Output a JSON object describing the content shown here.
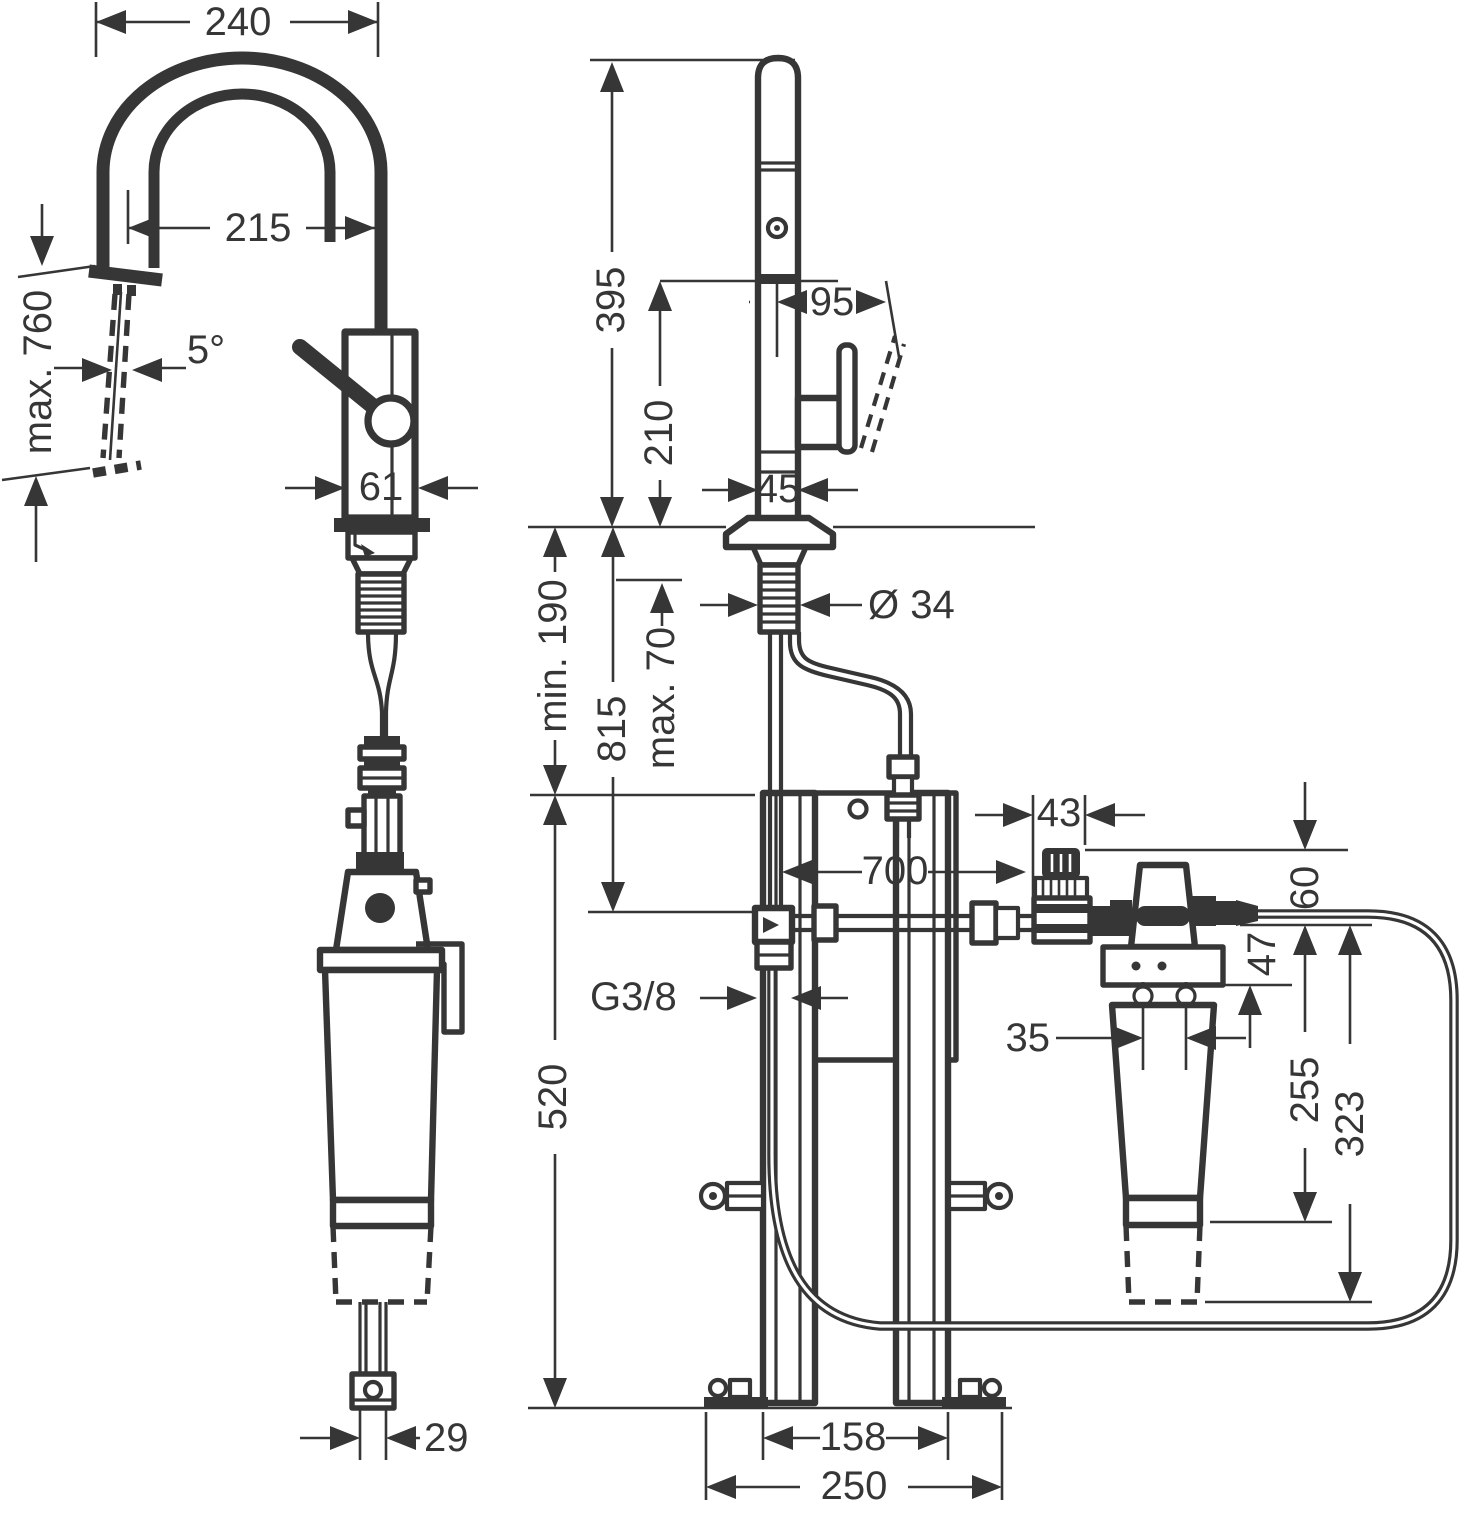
{
  "meta": {
    "background_color": "#ffffff",
    "line_color": "#363636",
    "drawing_kind": "installation dimension drawing, kitchen mixer with pull-out spray and under-sink filter unit",
    "views": [
      "side view with spout arc and filter cartridge",
      "front view with mounting frame, pressure regulator and filter"
    ]
  },
  "dims": {
    "spout_reach_outer": "240",
    "spout_reach_inner": "215",
    "pullout_max": "max. 760",
    "spray_angle": "5°",
    "body_width_side": "61",
    "hose_pair_width": "29",
    "height_above_deck": "395",
    "height_to_handle": "210",
    "handle_reach": "95",
    "body_width_front": "45",
    "clearance_min": "min. 190",
    "depth_total": "815",
    "deck_thickness_max": "max. 70",
    "shank_diameter": "Ø 34",
    "regulator_width": "43",
    "hose_run": "700",
    "drop_to_pipe": "60",
    "drop_to_filter_head": "47",
    "port_spacing": "35",
    "filter_length_short": "255",
    "filter_length_long": "323",
    "thread_size": "G3/8",
    "frame_drop": "520",
    "rail_spacing": "158",
    "base_width": "250"
  }
}
